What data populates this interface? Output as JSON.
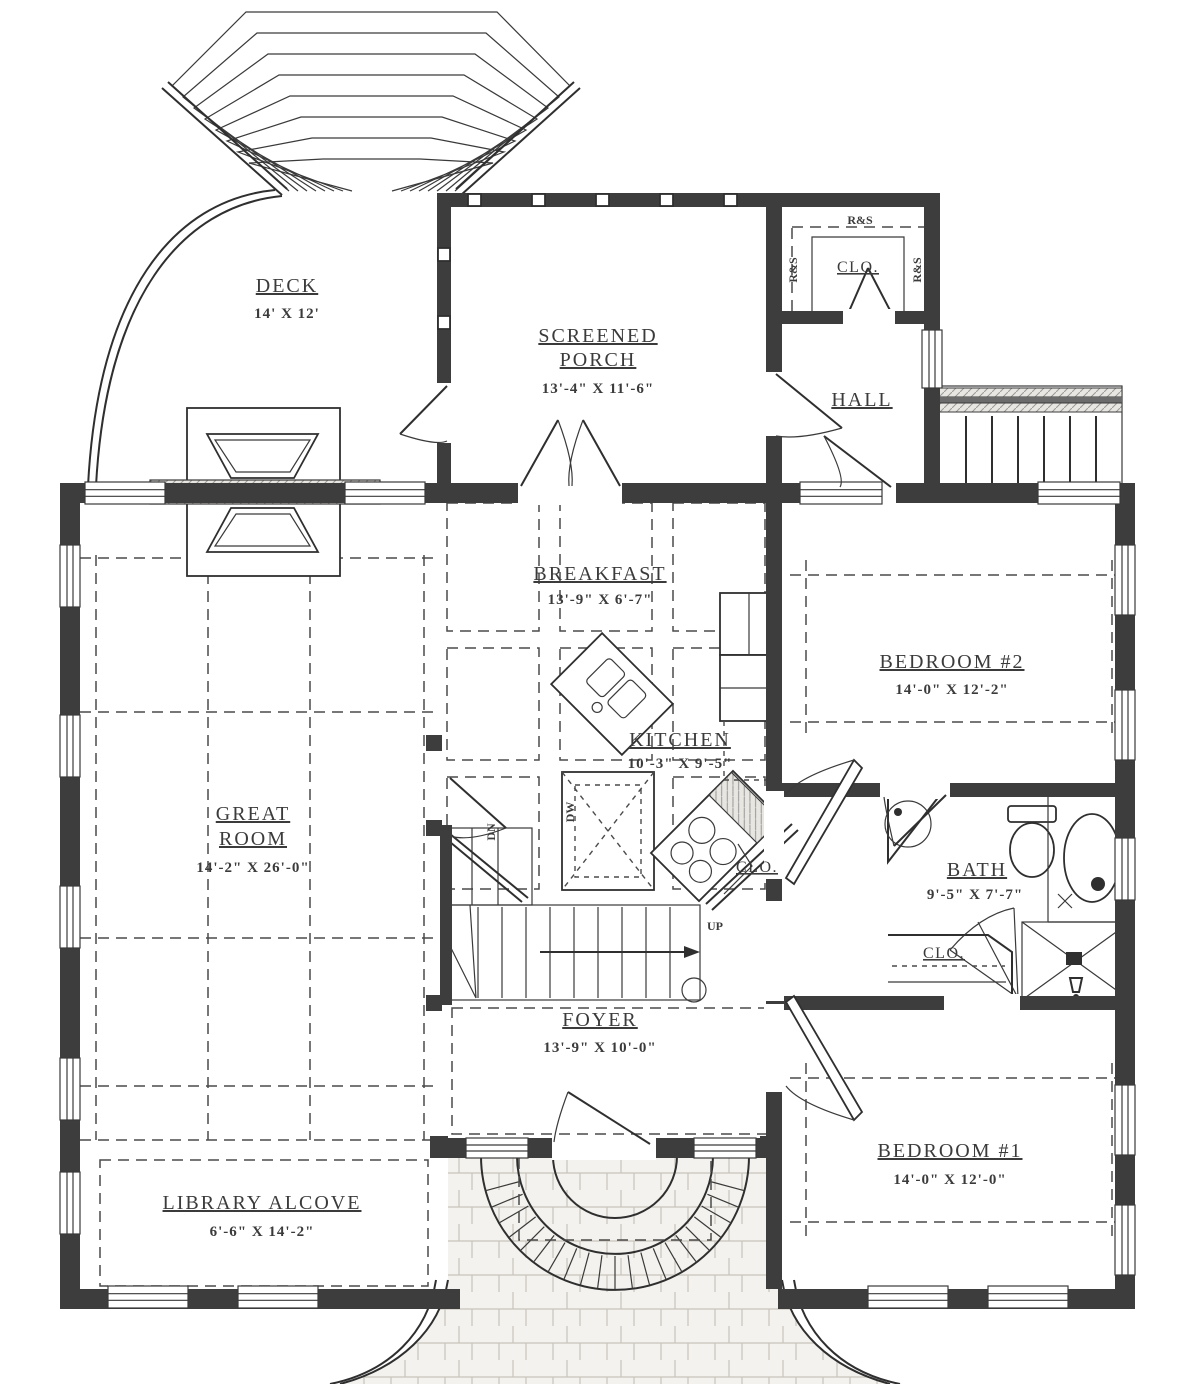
{
  "drawing": "first-floor-plan",
  "ink_color": "#2f2f2f",
  "rooms": {
    "deck": {
      "name": "DECK",
      "dims": "14' X 12'"
    },
    "screened_porch": {
      "name1": "SCREENED",
      "name2": "PORCH",
      "dims": "13'-4\" X 11'-6\""
    },
    "closet_top": {
      "name": "CLO."
    },
    "hall": {
      "name": "HALL"
    },
    "breakfast": {
      "name": "BREAKFAST",
      "dims": "13'-9\" X 6'-7\""
    },
    "bedroom2": {
      "name": "BEDROOM #2",
      "dims": "14'-0\" X 12'-2\""
    },
    "great_room": {
      "name1": "GREAT",
      "name2": "ROOM",
      "dims": "14'-2\" X 26'-0\""
    },
    "kitchen": {
      "name": "KITCHEN",
      "dims": "10'-3\" X 9'-5\""
    },
    "closet_kitchen": {
      "name": "CLO."
    },
    "bath": {
      "name": "BATH",
      "dims": "9'-5\" X 7'-7\""
    },
    "closet_bath": {
      "name": "CLO."
    },
    "foyer": {
      "name": "FOYER",
      "dims": "13'-9\" X 10'-0\""
    },
    "bedroom1": {
      "name": "BEDROOM #1",
      "dims": "14'-0\" X 12'-0\""
    },
    "library": {
      "name": "LIBRARY ALCOVE",
      "dims": "6'-6\" X 14'-2\""
    }
  },
  "annotations": {
    "rod_shelf": "R&S",
    "up": "UP",
    "down": "DN",
    "dishwasher": "DW"
  }
}
